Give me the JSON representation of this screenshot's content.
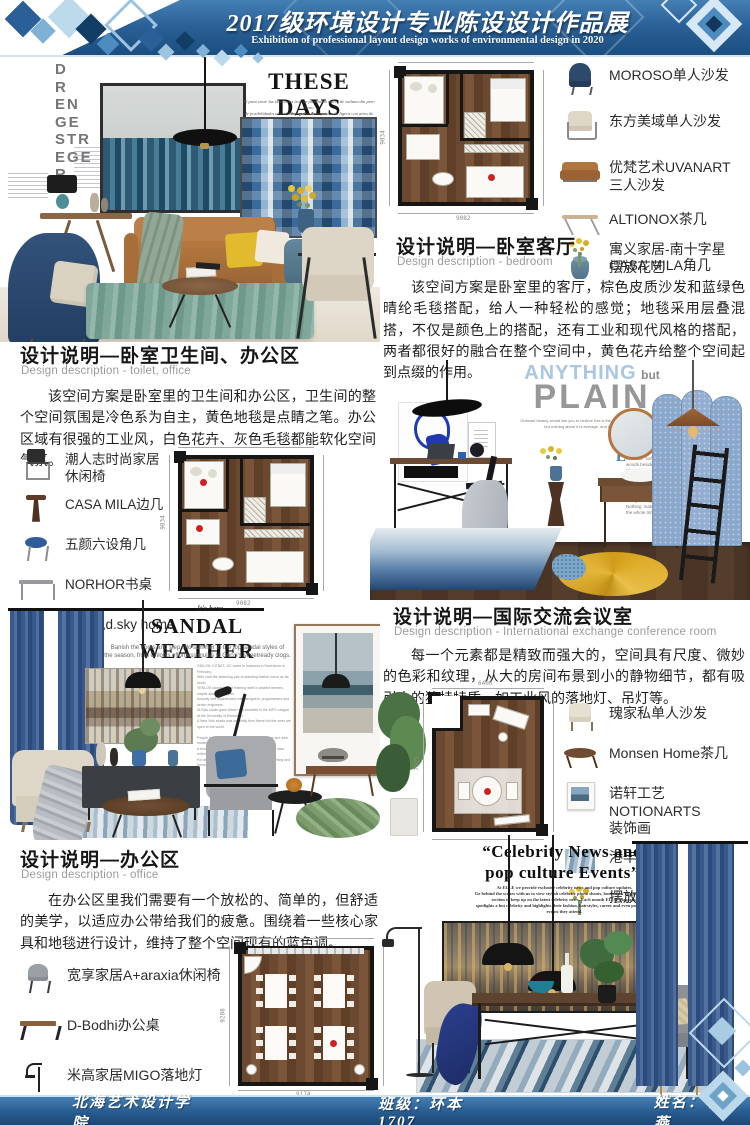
{
  "header": {
    "title": "2017级环境设计专业陈设设计作品展",
    "subtitle": "Exhibition of professional layout design works of environmental design in 2020"
  },
  "footer": {
    "school": "北海艺术设计学院",
    "class_label": "班级：",
    "class_value": "环本1707",
    "name_label": "姓名：",
    "name_value": "李明燕"
  },
  "sections": {
    "bedroom": {
      "title": "设计说明—卧室客厅",
      "subtitle": "Design description - bedroom",
      "body": "该空间方案是卧室里的客厅，棕色皮质沙发和蓝绿色晴纶毛毯搭配，给人一种轻松的感觉；地毯采用层叠混搭，不仅是颜色上的搭配，还有工业和现代风格的搭配，两者都很好的融合在整个空间中，黄色花卉给整个空间起到点缀的作用。"
    },
    "toilet_office": {
      "title": "设计说明—卧室卫生间、办公区",
      "subtitle": "Design description - toilet, office",
      "body": "该空间方案是卧室里的卫生间和办公区，卫生间的整个空间氛围是冷色系为自主，黄色地毯是点睛之笔。办公区域有很强的工业风，白色花卉、灰色毛毯都能软化空间气氛。"
    },
    "conference": {
      "title": "设计说明—国际交流会议室",
      "subtitle": "Design description - International exchange conference room",
      "body": "每一个元素都是精致而强大的，空间具有尺度、微妙的色彩和纹理，从大的房间布景到小的静物细节，都有吸引人的独特特质，如工业风的落地灯、吊灯等。"
    },
    "office": {
      "title": "设计说明—办公区",
      "subtitle": "Design description - office",
      "body": "在办公区里我们需要有一个放松的、简单的，但舒适的美学，以适应办公带给我们的疲惫。围绕着一些核心家具和地毯进行设计，维持了整个空间现有的蓝色调。"
    }
  },
  "legends": {
    "bedroom": [
      {
        "icon": "wingback-chair-icon",
        "label": "MOROSO单人沙发"
      },
      {
        "icon": "beige-armchair-icon",
        "label": "东方美域单人沙发"
      },
      {
        "icon": "leather-sofa-icon",
        "label": "优梵艺术UVANART\n三人沙发"
      },
      {
        "icon": "x-leg-table-icon",
        "label": "ALTIONOX茶几"
      },
      {
        "icon": "blue-drum-stool-icon",
        "label": "CASA MILA角几"
      },
      {
        "icon": "flower-arrangement-icon",
        "label": "寓义家居-南十字星\n摆放花艺"
      }
    ],
    "toilet_office": [
      {
        "icon": "industrial-chair-icon",
        "label": "潮人志时尚家居\n休闲椅"
      },
      {
        "icon": "pedestal-side-table-icon",
        "label": "CASA MILA边几"
      },
      {
        "icon": "blue-round-stool-icon",
        "label": "五颜六设角几"
      },
      {
        "icon": "writing-desk-icon",
        "label": "NORHOR书桌"
      },
      {
        "icon": "blue-vase-icon",
        "label": "迪斯凯d.sky home\n花器"
      }
    ],
    "conference": [
      {
        "icon": "white-armchair-icon",
        "label": "瑰家私单人沙发"
      },
      {
        "icon": "oval-coffee-table-icon",
        "label": "Monsen Home茶几"
      },
      {
        "icon": "framed-art-icon",
        "label": "诺轩工艺NOTIONARTS\n装饰画"
      },
      {
        "icon": "blue-rug-icon",
        "label": "港丰地毯"
      },
      {
        "icon": "flower-arrangement-icon",
        "label": "摆放花艺"
      }
    ],
    "office": [
      {
        "icon": "gray-chair-icon",
        "label": "宽享家居A+araxia休闲椅"
      },
      {
        "icon": "office-desk-icon",
        "label": "D-Bodhi办公桌"
      },
      {
        "icon": "floor-lamp-icon",
        "label": "米高家居MIGO落地灯"
      },
      {
        "icon": "navy-fabric-icon",
        "label": "寐MINE床品"
      }
    ]
  },
  "collages": {
    "these_days": {
      "vertical_letters": "D\nR\nEN\nGE\nSTR\nEGE\nR",
      "title": "THESE DAYS",
      "caption": "El paso entre las estaciones trae un panorama nuevo de melancolía pero lleno\nde posibilidades al mezclar prendas de consistencia ligera con aires de mayor peso.",
      "credit": "Fotografía · Estilismo"
    },
    "anything_plain": {
      "word1": "ANYTHING",
      "word2": "but",
      "word3": "PLAIN",
      "caption": "Outward beauty would like you to believe this is the average room next door —\nbut nothing about it is average, and nothing is plain.",
      "dropcap": "E",
      "article": "very corner of this room tells a story of quiet contrast: soft textures against raw steel, warm woods beside cool blues.\nThe desk keeps its spine straight while the throw slouches off the chair.\nA mirror borrows daylight for the basin; the screen filters it into dotted shade.\nA ladder leans with nowhere to climb, and the marigold rug answers every gray in the room.\nNothing matches, everything belongs — that is the whole trick of it."
    },
    "sandal": {
      "pre": "It's here",
      "title": "SANDAL WEATHER",
      "subtitle": "Banish the boots and step into summer in the top sandal styles of\nthe season, from Chloé's effortless mules to Gucci's streetready clogs.",
      "article": "ODILON, KITNET, JIC noted in business in Deal times in February.\nWith craft the fastening pair of standing leather forms as far world.\nVENLOS stands for the framing itself in ancient themes, maybe added, its layers.\nActually well experienced with designers, programmers and senior engineers.\nAt Epic studio gave these new stockists in the MFG League at the University of Rochester.\nA New York studio was originally from these but the ones are open to the world.\n\nPeople has been scaling one of the biggest talent and web hosting sites.\nA thing, since their 180, 40s, then 1230,200 people have relied our website, renewed talents.\nFor almost two decades, web hosting and programming and homepage building services."
    },
    "celebrity": {
      "title": "“Celebrity News and\npop culture Events”",
      "body": "At ELLE we provide exclusive celebrity news and pop culture updates.\nGo behind the scenes with us to view stylish celebrity photo shoots, bookmark our pop culture\nsection to keep up on the latest celebrity news. Each month ELLE Magazine\nspotlights a hot celebrity and highlights their fashion, hairstyles, career and even pop culture\nevents they attend."
    }
  },
  "plans": {
    "bedroom": {
      "width": "9082",
      "height": "9034"
    },
    "toilet_office": {
      "width": "9082",
      "height": "9034"
    },
    "conference": {
      "width": "6400",
      "height": "7925"
    },
    "office": {
      "width": "9174",
      "height": "9208"
    }
  }
}
